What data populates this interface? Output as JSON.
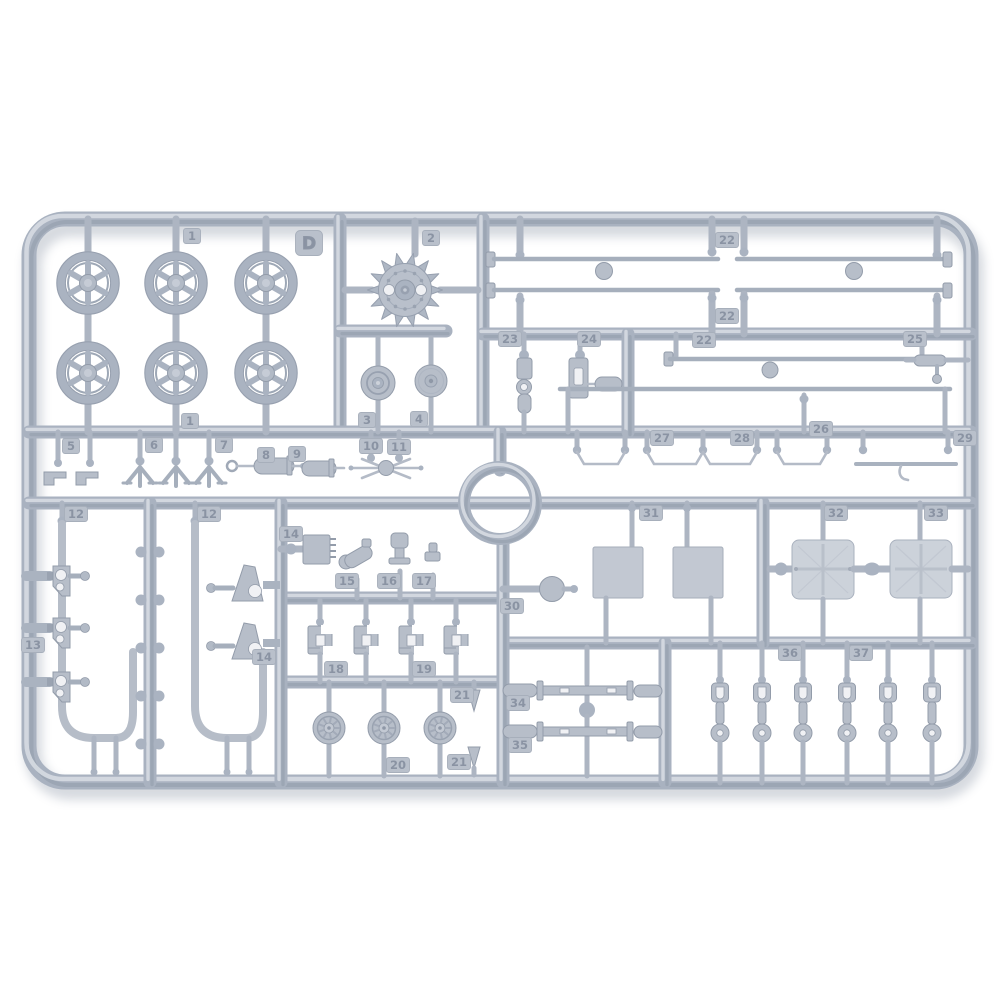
{
  "scene": {
    "description": "Injection-molded light grey plastic model kit sprue (parts runner) on a white background",
    "sprue_letter": "D",
    "numbered_parts_visible": [
      "1",
      "2",
      "3",
      "4",
      "5",
      "6",
      "7",
      "8",
      "9",
      "10",
      "11",
      "12",
      "13",
      "14",
      "15",
      "16",
      "17",
      "18",
      "19",
      "20",
      "21",
      "22",
      "23",
      "24",
      "25",
      "26",
      "27",
      "28",
      "29",
      "30",
      "31",
      "32",
      "33",
      "34",
      "35",
      "36",
      "37"
    ]
  },
  "colors": {
    "background": "#ffffff",
    "plastic_mid": "#a9b2c0",
    "plastic_light": "#d4d9e0",
    "plastic_dark": "#8f99a8",
    "part_fill": "#b7bec9",
    "part_stroke": "#939caa",
    "plate_fill": "#c2c8d2",
    "plate_light": "#ccd2da",
    "hole_fill": "#f0f1f4",
    "tag_fill": "#b9c0cb",
    "tag_stroke": "#a7afbb",
    "tag_text": "#8a93a3",
    "shadow": "#7f8a9c"
  },
  "part_labels": [
    {
      "text": "1",
      "x": 192,
      "y": 236
    },
    {
      "text": "1",
      "x": 190,
      "y": 421
    },
    {
      "text": "D",
      "x": 309,
      "y": 243,
      "letter": true
    },
    {
      "text": "2",
      "x": 431,
      "y": 238
    },
    {
      "text": "3",
      "x": 367,
      "y": 420
    },
    {
      "text": "4",
      "x": 419,
      "y": 419
    },
    {
      "text": "5",
      "x": 71,
      "y": 446
    },
    {
      "text": "6",
      "x": 154,
      "y": 445
    },
    {
      "text": "7",
      "x": 224,
      "y": 445
    },
    {
      "text": "8",
      "x": 266,
      "y": 455
    },
    {
      "text": "9",
      "x": 297,
      "y": 454
    },
    {
      "text": "10",
      "x": 371,
      "y": 446
    },
    {
      "text": "11",
      "x": 399,
      "y": 447
    },
    {
      "text": "12",
      "x": 76,
      "y": 514
    },
    {
      "text": "12",
      "x": 209,
      "y": 514
    },
    {
      "text": "13",
      "x": 33,
      "y": 645
    },
    {
      "text": "14",
      "x": 291,
      "y": 534
    },
    {
      "text": "14",
      "x": 264,
      "y": 657
    },
    {
      "text": "15",
      "x": 347,
      "y": 581
    },
    {
      "text": "16",
      "x": 389,
      "y": 581
    },
    {
      "text": "17",
      "x": 424,
      "y": 581
    },
    {
      "text": "18",
      "x": 336,
      "y": 669
    },
    {
      "text": "19",
      "x": 424,
      "y": 669
    },
    {
      "text": "20",
      "x": 398,
      "y": 765
    },
    {
      "text": "21",
      "x": 462,
      "y": 695
    },
    {
      "text": "21",
      "x": 459,
      "y": 762
    },
    {
      "text": "22",
      "x": 727,
      "y": 240
    },
    {
      "text": "22",
      "x": 727,
      "y": 316
    },
    {
      "text": "22",
      "x": 704,
      "y": 340
    },
    {
      "text": "23",
      "x": 510,
      "y": 339
    },
    {
      "text": "24",
      "x": 589,
      "y": 339
    },
    {
      "text": "25",
      "x": 915,
      "y": 339
    },
    {
      "text": "26",
      "x": 821,
      "y": 429
    },
    {
      "text": "27",
      "x": 662,
      "y": 438
    },
    {
      "text": "28",
      "x": 742,
      "y": 438
    },
    {
      "text": "29",
      "x": 965,
      "y": 438
    },
    {
      "text": "30",
      "x": 512,
      "y": 606
    },
    {
      "text": "31",
      "x": 651,
      "y": 513
    },
    {
      "text": "32",
      "x": 836,
      "y": 513
    },
    {
      "text": "33",
      "x": 936,
      "y": 513
    },
    {
      "text": "34",
      "x": 518,
      "y": 703
    },
    {
      "text": "35",
      "x": 520,
      "y": 745
    },
    {
      "text": "36",
      "x": 790,
      "y": 653
    },
    {
      "text": "37",
      "x": 861,
      "y": 653
    }
  ]
}
